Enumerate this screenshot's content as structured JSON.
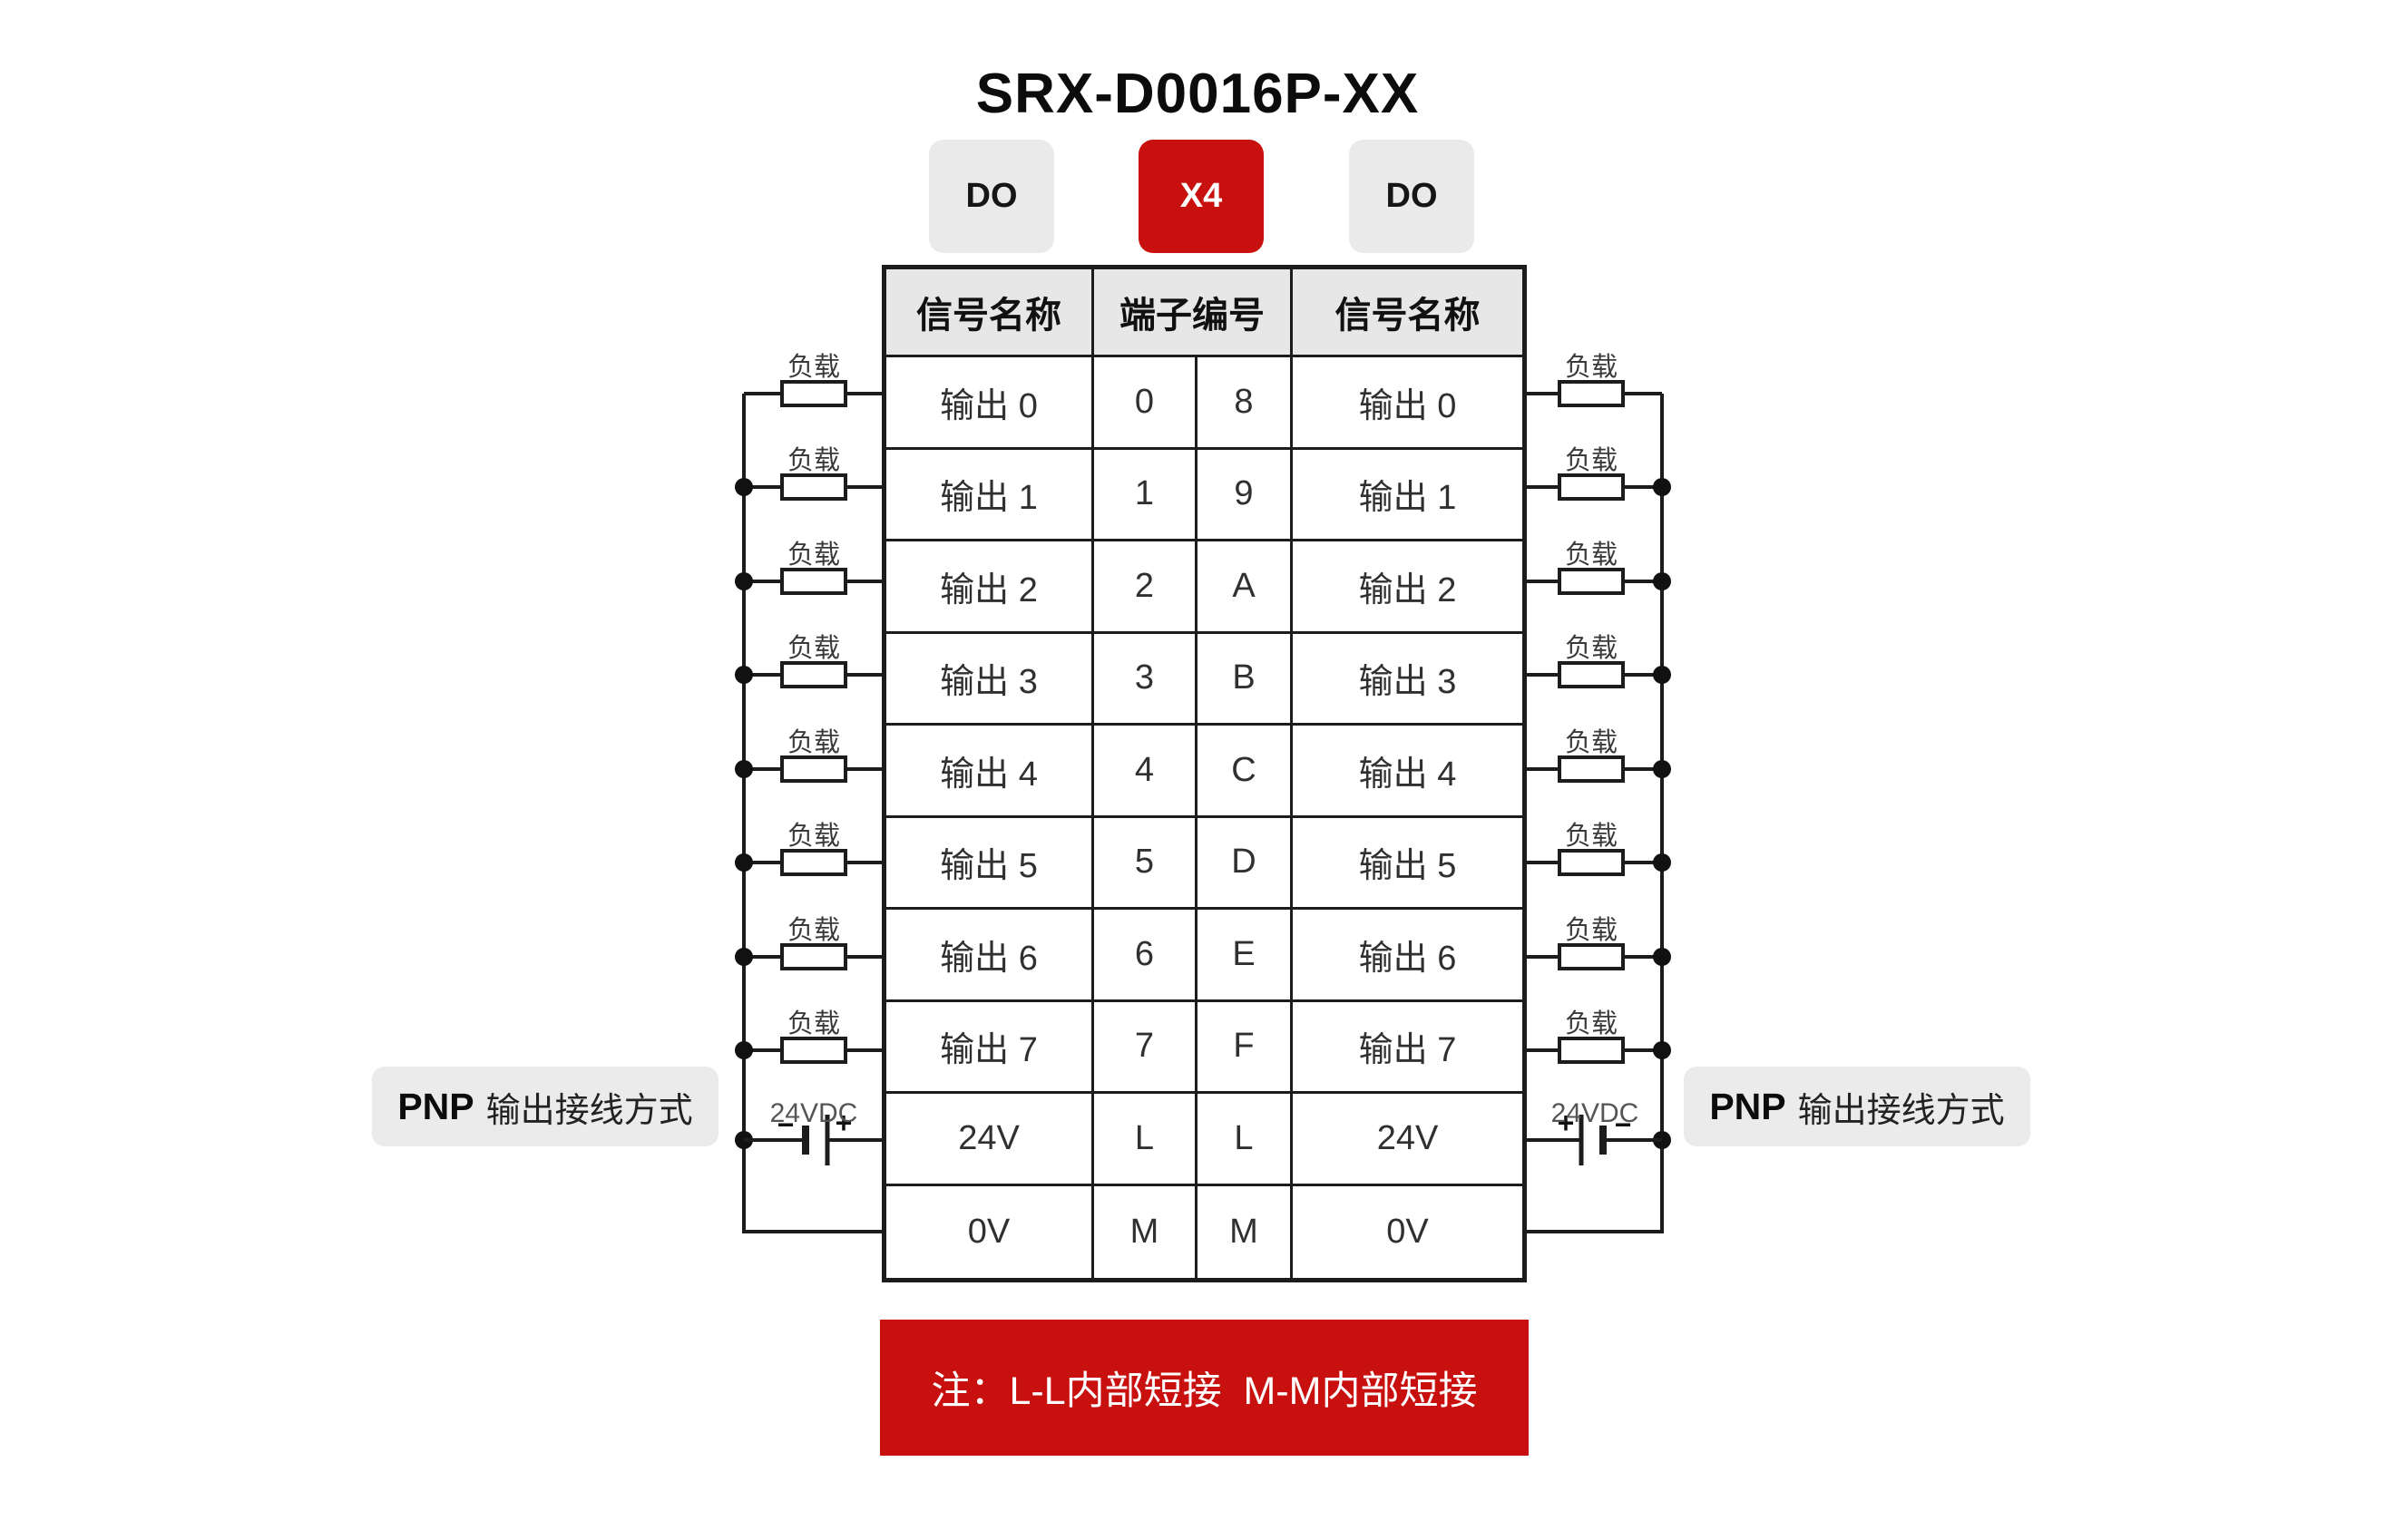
{
  "title": "SRX-D0016P-XX",
  "badges": {
    "left": "DO",
    "center": "X4",
    "right": "DO"
  },
  "colors": {
    "accent_red": "#c8100e",
    "badge_gray": "#eaeaea",
    "header_gray": "#e7e7e7",
    "line_black": "#1c1c1c"
  },
  "table": {
    "headers": {
      "left": "信号名称",
      "center": "端子编号",
      "right": "信号名称"
    },
    "rows": [
      {
        "left": "输出 0",
        "t1": "0",
        "t2": "8",
        "right": "输出 0"
      },
      {
        "left": "输出 1",
        "t1": "1",
        "t2": "9",
        "right": "输出 1"
      },
      {
        "left": "输出 2",
        "t1": "2",
        "t2": "A",
        "right": "输出 2"
      },
      {
        "left": "输出 3",
        "t1": "3",
        "t2": "B",
        "right": "输出 3"
      },
      {
        "left": "输出 4",
        "t1": "4",
        "t2": "C",
        "right": "输出 4"
      },
      {
        "left": "输出 5",
        "t1": "5",
        "t2": "D",
        "right": "输出 5"
      },
      {
        "left": "输出 6",
        "t1": "6",
        "t2": "E",
        "right": "输出 6"
      },
      {
        "left": "输出 7",
        "t1": "7",
        "t2": "F",
        "right": "输出 7"
      },
      {
        "left": "24V",
        "t1": "L",
        "t2": "L",
        "right": "24V"
      },
      {
        "left": "0V",
        "t1": "M",
        "t2": "M",
        "right": "0V"
      }
    ]
  },
  "wiring": {
    "load_label": "负载",
    "supply_label": "24VDC",
    "plus": "+",
    "minus": "−",
    "pnp_bold": "PNP",
    "pnp_rest": "输出接线方式"
  },
  "note": "注：L-L内部短接  M-M内部短接"
}
